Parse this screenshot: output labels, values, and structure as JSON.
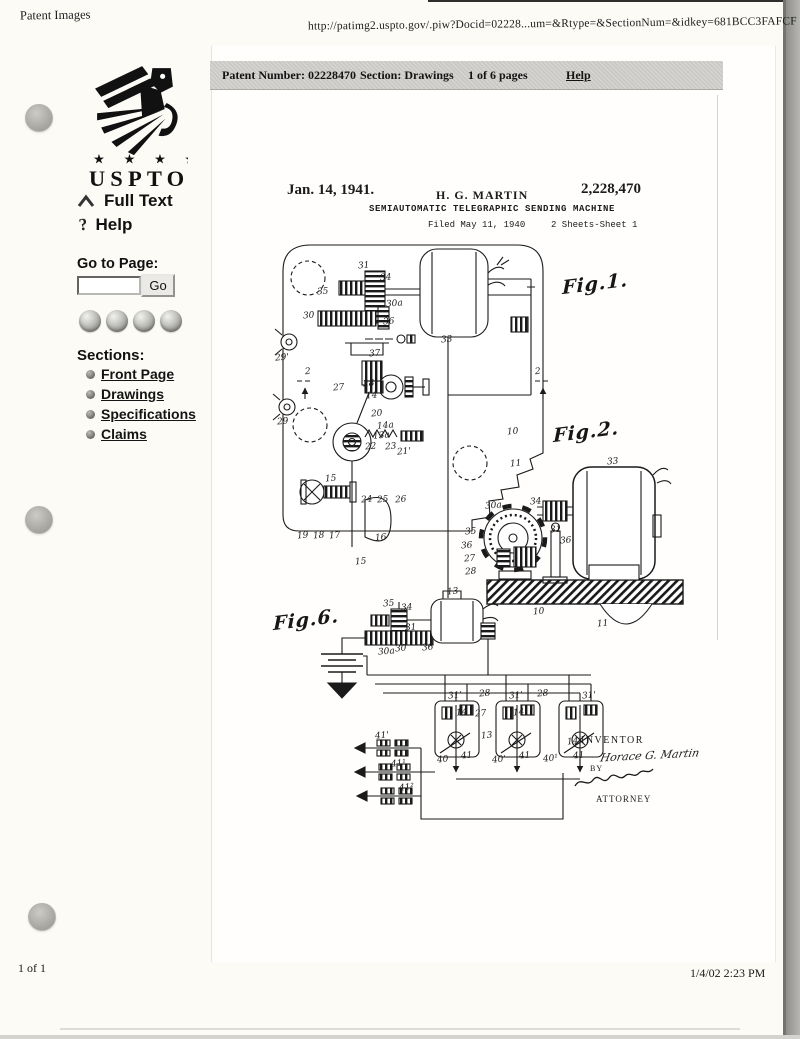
{
  "header": {
    "app_label": "Patent Images",
    "url": "http://patimg2.uspto.gov/.piw?Docid=02228...um=&Rtype=&SectionNum=&idkey=681BCC3FAFCF"
  },
  "toolbar": {
    "patent_number": "Patent Number: 02228470",
    "section": "Section: Drawings",
    "pages": "1 of 6 pages",
    "help": "Help"
  },
  "sidebar": {
    "logo_text": "USPTO",
    "logo_stars": "★ ★ ★ ★",
    "full_text_label": "Full Text",
    "help_label": "Help",
    "goto_label": "Go to Page:",
    "goto_value": "",
    "go_button_label": "Go",
    "nav_buttons": [
      "nav-ball-1-icon",
      "nav-ball-2-icon",
      "nav-ball-3-icon",
      "nav-ball-4-icon"
    ],
    "sections_heading": "Sections:",
    "sections": [
      "Front Page",
      "Drawings",
      "Specifications",
      "Claims"
    ]
  },
  "sheet": {
    "date": "Jan. 14, 1941.",
    "inventor": "H. G. MARTIN",
    "patent_number": "2,228,470",
    "title": "SEMIAUTOMATIC TELEGRAPHIC SENDING MACHINE",
    "filed": "Filed May 11, 1940",
    "sheet_info": "2 Sheets-Sheet 1",
    "inventor_caption": "INVENTOR",
    "by_label": "BY",
    "inventor_signature": "Horace G. Martin",
    "attorney_caption": "ATTORNEY"
  },
  "footer": {
    "page_count": "1 of 1",
    "timestamp": "1/4/02 2:23 PM"
  },
  "colors": {
    "paper": "#fcfbf6",
    "sheet": "#fffefc",
    "toolbar_gray": "#cac9c5",
    "ink": "#1b1b1b",
    "hole_gray": "#a9a8a2"
  },
  "drawing": {
    "labels": [
      {
        "t": "Fig.1.",
        "x": 347,
        "y": 38,
        "cls": "script"
      },
      {
        "t": "Fig.2.",
        "x": 338,
        "y": 186,
        "cls": "script"
      },
      {
        "t": "Fig.6.",
        "x": 58,
        "y": 374,
        "cls": "script"
      },
      {
        "t": "31",
        "x": 143,
        "y": 26
      },
      {
        "t": "34",
        "x": 165,
        "y": 38
      },
      {
        "t": "35",
        "x": 102,
        "y": 52
      },
      {
        "t": "30",
        "x": 88,
        "y": 76
      },
      {
        "t": "30a",
        "x": 171,
        "y": 64
      },
      {
        "t": "36",
        "x": 168,
        "y": 82
      },
      {
        "t": "33",
        "x": 226,
        "y": 100
      },
      {
        "t": "37",
        "x": 154,
        "y": 114
      },
      {
        "t": "27",
        "x": 118,
        "y": 148
      },
      {
        "t": "28",
        "x": 148,
        "y": 144
      },
      {
        "t": "14",
        "x": 151,
        "y": 156
      },
      {
        "t": "2",
        "x": 90,
        "y": 132
      },
      {
        "t": "2",
        "x": 320,
        "y": 132
      },
      {
        "t": "29'",
        "x": 60,
        "y": 118
      },
      {
        "t": "29",
        "x": 62,
        "y": 182
      },
      {
        "t": "20",
        "x": 156,
        "y": 174
      },
      {
        "t": "14a",
        "x": 162,
        "y": 186
      },
      {
        "t": "13a",
        "x": 158,
        "y": 196
      },
      {
        "t": "22",
        "x": 150,
        "y": 207
      },
      {
        "t": "23",
        "x": 170,
        "y": 207
      },
      {
        "t": "21'",
        "x": 182,
        "y": 212
      },
      {
        "t": "15",
        "x": 110,
        "y": 239
      },
      {
        "t": "24",
        "x": 146,
        "y": 260
      },
      {
        "t": "25",
        "x": 162,
        "y": 260
      },
      {
        "t": "26",
        "x": 180,
        "y": 260
      },
      {
        "t": "19",
        "x": 82,
        "y": 296
      },
      {
        "t": "18",
        "x": 98,
        "y": 296
      },
      {
        "t": "17",
        "x": 114,
        "y": 296
      },
      {
        "t": "16",
        "x": 160,
        "y": 298
      },
      {
        "t": "15",
        "x": 140,
        "y": 322
      },
      {
        "t": "10",
        "x": 292,
        "y": 192
      },
      {
        "t": "11",
        "x": 295,
        "y": 224
      },
      {
        "t": "33",
        "x": 392,
        "y": 222
      },
      {
        "t": "30a",
        "x": 270,
        "y": 266
      },
      {
        "t": "34",
        "x": 315,
        "y": 262
      },
      {
        "t": "35",
        "x": 250,
        "y": 292
      },
      {
        "t": "36",
        "x": 246,
        "y": 306
      },
      {
        "t": "27",
        "x": 249,
        "y": 319
      },
      {
        "t": "28",
        "x": 250,
        "y": 332
      },
      {
        "t": "31",
        "x": 335,
        "y": 290
      },
      {
        "t": "36",
        "x": 345,
        "y": 301
      },
      {
        "t": "13",
        "x": 232,
        "y": 352
      },
      {
        "t": "10",
        "x": 318,
        "y": 372
      },
      {
        "t": "11",
        "x": 382,
        "y": 384
      },
      {
        "t": "35",
        "x": 168,
        "y": 364
      },
      {
        "t": "34",
        "x": 186,
        "y": 368
      },
      {
        "t": "31",
        "x": 190,
        "y": 388
      },
      {
        "t": "30a",
        "x": 163,
        "y": 412
      },
      {
        "t": "30",
        "x": 180,
        "y": 409
      },
      {
        "t": "36",
        "x": 207,
        "y": 408
      },
      {
        "t": "31'",
        "x": 233,
        "y": 456
      },
      {
        "t": "28",
        "x": 264,
        "y": 454
      },
      {
        "t": "27",
        "x": 260,
        "y": 474
      },
      {
        "t": "14",
        "x": 241,
        "y": 473
      },
      {
        "t": "31'",
        "x": 294,
        "y": 456
      },
      {
        "t": "28",
        "x": 322,
        "y": 454
      },
      {
        "t": "14",
        "x": 298,
        "y": 473
      },
      {
        "t": "31'",
        "x": 367,
        "y": 456
      },
      {
        "t": "13",
        "x": 266,
        "y": 496
      },
      {
        "t": "14",
        "x": 352,
        "y": 502
      },
      {
        "t": "40",
        "x": 222,
        "y": 520
      },
      {
        "t": "41",
        "x": 246,
        "y": 516
      },
      {
        "t": "40'",
        "x": 277,
        "y": 520
      },
      {
        "t": "41",
        "x": 304,
        "y": 516
      },
      {
        "t": "40¹",
        "x": 328,
        "y": 519
      },
      {
        "t": "41",
        "x": 358,
        "y": 516
      },
      {
        "t": "41'",
        "x": 160,
        "y": 496
      },
      {
        "t": "41¹",
        "x": 176,
        "y": 524
      },
      {
        "t": "41²",
        "x": 184,
        "y": 548
      }
    ]
  }
}
